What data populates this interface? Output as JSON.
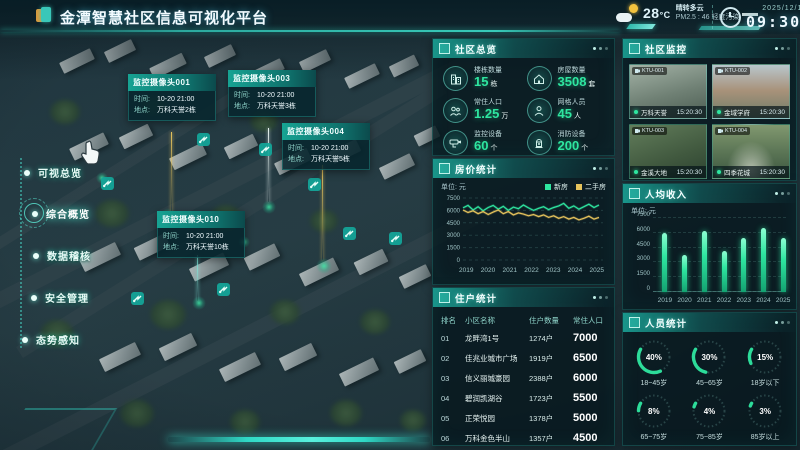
{
  "header": {
    "title": "金潭智慧社区信息可视化平台",
    "weather": {
      "temp": "28",
      "temp_unit": "°C",
      "condition": "晴转多云",
      "pm25": "PM2.5 : 46",
      "pollution": "轻度污染"
    },
    "datetime": {
      "date": "2025/12/10",
      "weekday": "星期三",
      "time": "09:30:05"
    }
  },
  "nav": {
    "items": [
      {
        "label": "可视总览",
        "active": false
      },
      {
        "label": "综合概览",
        "active": true
      },
      {
        "label": "数据稽核",
        "active": false
      },
      {
        "label": "安全管理",
        "active": false
      },
      {
        "label": "态势感知",
        "active": false
      }
    ]
  },
  "map": {
    "tooltips": [
      {
        "title": "监控摄像头001",
        "time_label": "时间:",
        "time": "10-20 21:00",
        "place_label": "地点:",
        "place": "万科天誉2栋"
      },
      {
        "title": "监控摄像头003",
        "time_label": "时间:",
        "time": "10-20 21:00",
        "place_label": "地点:",
        "place": "万科天誉3栋"
      },
      {
        "title": "监控摄像头004",
        "time_label": "时间:",
        "time": "10-20 21:00",
        "place_label": "地点:",
        "place": "万科天誉5栋"
      },
      {
        "title": "监控摄像头010",
        "time_label": "时间:",
        "time": "10-20 21:00",
        "place_label": "地点:",
        "place": "万科天誉10栋"
      }
    ]
  },
  "overview": {
    "title": "社区总览",
    "stats": [
      {
        "icon": "building-icon",
        "label": "楼栋数量",
        "value": "15",
        "unit": "栋"
      },
      {
        "icon": "house-icon",
        "label": "房屋数量",
        "value": "3508",
        "unit": "套"
      },
      {
        "icon": "population-icon",
        "label": "常住人口",
        "value": "1.25",
        "unit": "万"
      },
      {
        "icon": "person-icon",
        "label": "网格人员",
        "value": "45",
        "unit": "人"
      },
      {
        "icon": "cctv-icon",
        "label": "监控设备",
        "value": "60",
        "unit": "个"
      },
      {
        "icon": "hydrant-icon",
        "label": "消防设备",
        "value": "200",
        "unit": "个"
      }
    ]
  },
  "housing": {
    "title": "房价统计"
  },
  "residents": {
    "title": "住户统计",
    "headers": [
      "排名",
      "小区名称",
      "住户数量",
      "常住人口"
    ],
    "rows": [
      [
        "01",
        "龙畔湾1号",
        "1274户",
        "7000"
      ],
      [
        "02",
        "佳兆业城市广场",
        "1919户",
        "6500"
      ],
      [
        "03",
        "信义丽城豪园",
        "2388户",
        "6000"
      ],
      [
        "04",
        "碧润凯湖谷",
        "1723户",
        "5500"
      ],
      [
        "05",
        "正荣悦园",
        "1378户",
        "5000"
      ],
      [
        "06",
        "万科金色半山",
        "1357户",
        "4500"
      ]
    ]
  },
  "monitoring": {
    "title": "社区监控",
    "cameras": [
      {
        "cam_id": "KTU-001",
        "name": "万科天誉",
        "time": "15:20:30"
      },
      {
        "cam_id": "KTU-002",
        "name": "金域学府",
        "time": "15:20:30"
      },
      {
        "cam_id": "KTU-003",
        "name": "金溪大地",
        "time": "15:20:30"
      },
      {
        "cam_id": "KTU-004",
        "name": "四季花城",
        "time": "15:20:30"
      }
    ]
  },
  "income": {
    "title": "人均收入"
  },
  "demographics": {
    "title": "人员统计",
    "rings": [
      {
        "pct": 40,
        "label": "18~45岁"
      },
      {
        "pct": 30,
        "label": "45~65岁"
      },
      {
        "pct": 15,
        "label": "18岁以下"
      },
      {
        "pct": 8,
        "label": "65~75岁"
      },
      {
        "pct": 4,
        "label": "75~85岁"
      },
      {
        "pct": 3,
        "label": "85岁以上"
      }
    ]
  },
  "colors": {
    "accent_teal": "#2fb8ab",
    "accent_green": "#2ee6a0",
    "accent_yellow": "#e6c35c"
  },
  "chart_data": [
    {
      "type": "line",
      "title": "房价统计",
      "unit_label": "单位: 元",
      "x_ticks": [
        "2019",
        "2020",
        "2021",
        "2022",
        "2023",
        "2024",
        "2025"
      ],
      "ylim": [
        0,
        7500
      ],
      "y_ticks": [
        0,
        1500,
        3000,
        4500,
        6000,
        7500
      ],
      "grid": true,
      "legend_position": "top-right",
      "series": [
        {
          "name": "新房",
          "color": "#2ee6a0",
          "values": [
            6300,
            6600,
            6050,
            6450,
            5950,
            6350,
            6600,
            6150,
            6500,
            6000,
            6400,
            6200,
            6650,
            6300,
            6000,
            6250,
            6450,
            6100,
            6350,
            6550,
            6850,
            6250,
            6550,
            6150,
            6450,
            6750,
            6350,
            6650
          ]
        },
        {
          "name": "二手房",
          "color": "#e6c35c",
          "values": [
            6050,
            5750,
            5950,
            5600,
            5850,
            5500,
            5800,
            6050,
            5600,
            5850,
            5450,
            5700,
            5550,
            5350,
            5500,
            5250,
            5450,
            5150,
            5350,
            5050,
            5250,
            4950,
            5150,
            4850,
            5050,
            5300,
            4950,
            5150
          ]
        }
      ]
    },
    {
      "type": "bar",
      "title": "人均收入",
      "unit_label": "单位: 元",
      "categories": [
        "2019",
        "2020",
        "2021",
        "2022",
        "2023",
        "2024",
        "2025"
      ],
      "values": [
        6000,
        3800,
        6200,
        4200,
        5500,
        6500,
        5500
      ],
      "ylim": [
        0,
        7500
      ],
      "y_ticks": [
        0,
        1500,
        3000,
        4500,
        6000,
        7500
      ],
      "grid": true,
      "bar_color": "#2ee6a0"
    }
  ]
}
